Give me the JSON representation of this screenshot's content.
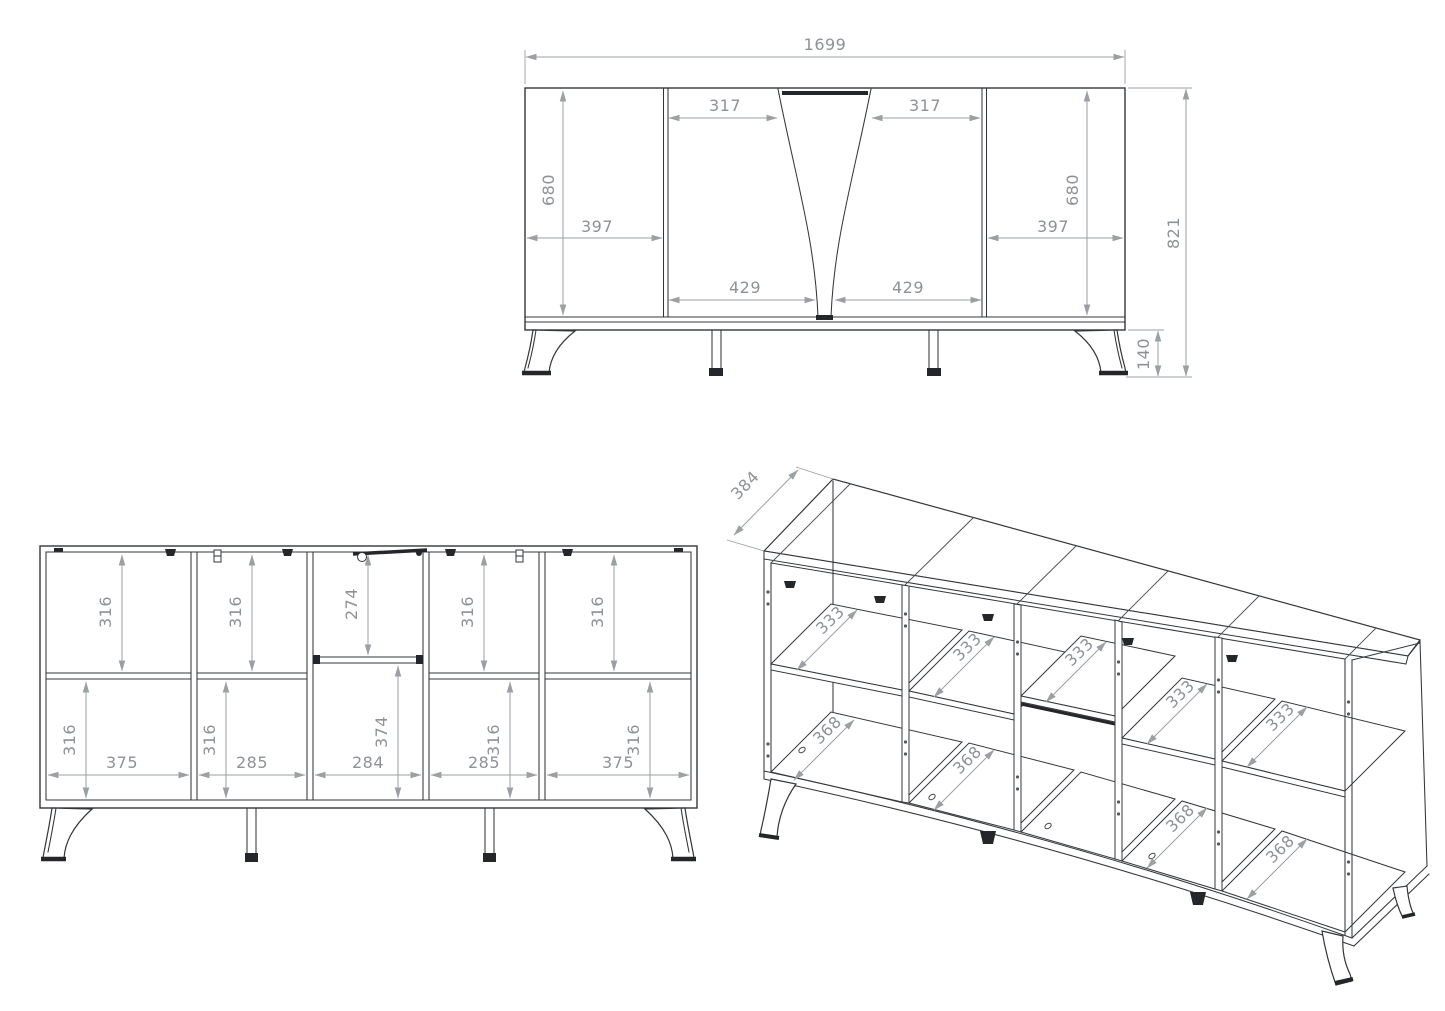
{
  "title": "sideboard-technical-drawing",
  "colors": {
    "line": "#33373b",
    "dimension": "#9aa0a5",
    "background": "#ffffff",
    "hardware": "#23262a"
  },
  "front_view": {
    "overall_width": "1699",
    "overall_height": "821",
    "leg_height": "140",
    "left_door_height": "680",
    "left_door_width": "397",
    "right_door_height": "680",
    "right_door_width": "397",
    "mid_top_left": "317",
    "mid_top_right": "317",
    "mid_bottom_left": "429",
    "mid_bottom_right": "429"
  },
  "internal_view": {
    "top_heights": [
      "316",
      "316",
      "274",
      "316",
      "316"
    ],
    "bottom_heights": [
      "316",
      "316",
      "374",
      "316",
      "316"
    ],
    "widths": [
      "375",
      "285",
      "284",
      "285",
      "375"
    ]
  },
  "iso_view": {
    "depth": "384",
    "shelf_depths": [
      "333",
      "333",
      "333",
      "333",
      "333"
    ],
    "bottom_depths": [
      "368",
      "368",
      "368",
      "368"
    ]
  }
}
